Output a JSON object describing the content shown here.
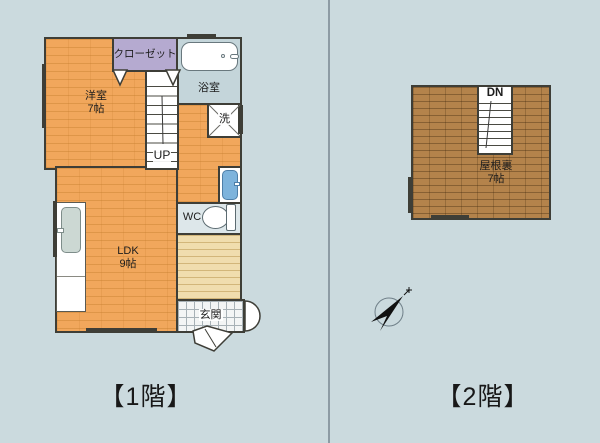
{
  "floor1": {
    "caption": "【1階】",
    "rooms": {
      "western": {
        "name": "洋室",
        "size": "7帖"
      },
      "closet": {
        "name": "クローゼット"
      },
      "bath": {
        "name": "浴室"
      },
      "laundry": {
        "name": "洗"
      },
      "wc": {
        "name": "WC"
      },
      "ldk": {
        "name": "LDK",
        "size": "9帖"
      },
      "entrance": {
        "name": "玄関"
      },
      "stairs": {
        "direction": "UP"
      }
    }
  },
  "floor2": {
    "caption": "【2階】",
    "rooms": {
      "attic": {
        "name": "屋根裏",
        "size": "7帖"
      },
      "stairs": {
        "direction": "DN"
      }
    }
  },
  "colors": {
    "background": "#cbdade",
    "divider": "#8d9ba4",
    "wall": "#3e3e37",
    "floor-orange": "#f1a75c",
    "floor-wood": "#b4834b",
    "closet-purple": "#b5aad0",
    "bath-blue": "#c4d5da",
    "hall-tan": "#f0ddae",
    "fixture-blue": "#7db3dc",
    "sink-gray": "#ccd8d3"
  }
}
